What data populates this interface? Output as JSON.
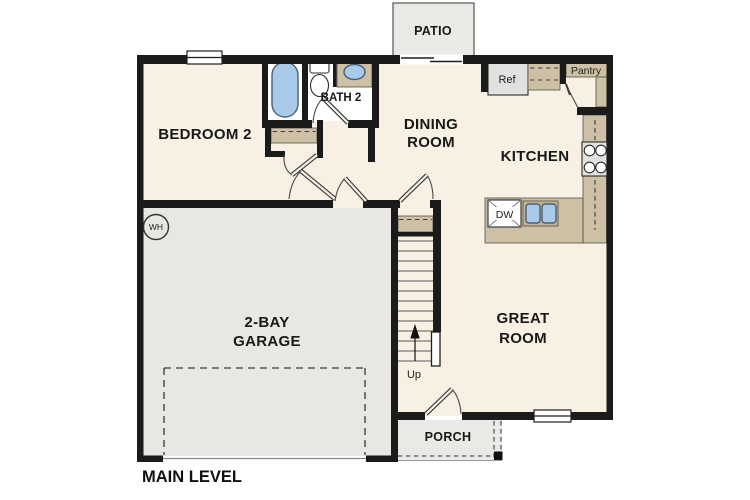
{
  "plan_title": "MAIN LEVEL",
  "rooms": {
    "patio": "PATIO",
    "bedroom2": "BEDROOM 2",
    "bath2": "BATH 2",
    "dining_line1": "DINING",
    "dining_line2": "ROOM",
    "kitchen": "KITCHEN",
    "great_line1": "GREAT",
    "great_line2": "ROOM",
    "garage_line1": "2-BAY",
    "garage_line2": "GARAGE",
    "porch": "PORCH",
    "pantry": "Pantry"
  },
  "fixtures": {
    "refrigerator": "Ref",
    "dishwasher": "DW",
    "water_heater": "WH",
    "stairs_direction": "Up"
  },
  "colors": {
    "wall": "#1b1b1b",
    "interior_floor": "#f7f0e3",
    "garage_floor": "#e8e7e4",
    "outdoor_gray": "#e9e9e6",
    "counter_tan": "#cec0a4",
    "fixture_blue": "#a9cbe9",
    "appliance_gray": "#e1e1df"
  }
}
